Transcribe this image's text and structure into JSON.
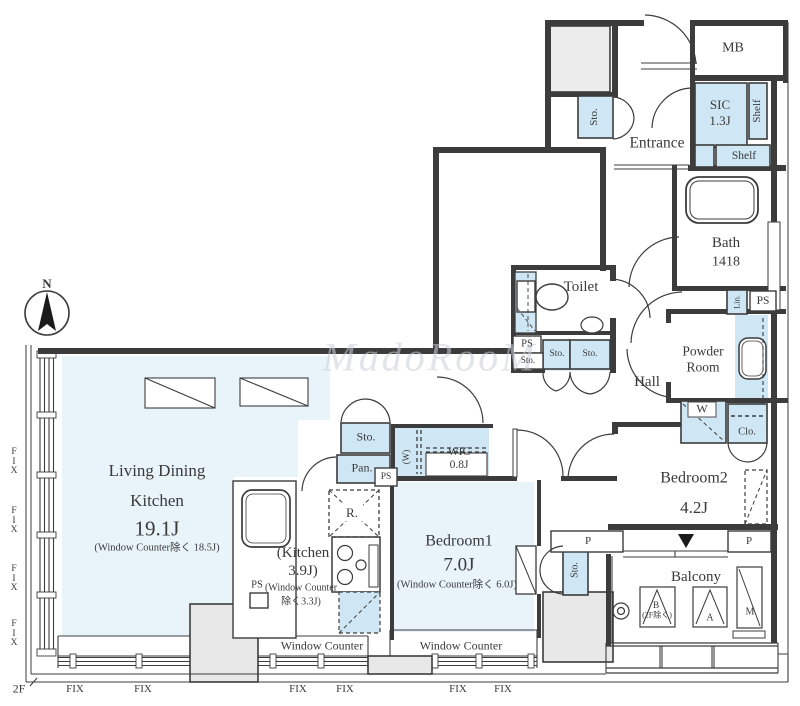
{
  "colors": {
    "wall": "#3c3c3c",
    "storage_fill": "#cfe6f4",
    "room_fill": "#e9f3fa",
    "column_fill": "#e8e8e8",
    "watermark": "#c9cfd6"
  },
  "compass": {
    "label": "N"
  },
  "floor_tag": {
    "label": "2F"
  },
  "watermark": {
    "text": "MadoRooM"
  },
  "labels": {
    "fix": "FIX",
    "fix_v": "F\nI\nX",
    "ps": "PS",
    "sto": "Sto.",
    "pan": "Pan.",
    "shelf": "Shelf",
    "lin": "Lin.",
    "clo": "Clo.",
    "washer": "W",
    "w_rot": "(W)",
    "fridge": "R.",
    "pipe": "P",
    "mb": "MB",
    "window_counter": "Window Counter",
    "ac_b": "B",
    "ac_b_note": "(2F除く)",
    "ac_a": "A",
    "ac_m": "M"
  },
  "rooms": {
    "ldk": {
      "line1": "Living Dining",
      "line2": "Kitchen",
      "size": "19.1J",
      "note": "(Window Counter除く 18.5J)"
    },
    "kitchen": {
      "line1": "(Kitchen",
      "line2": "3.9J)",
      "line3": "(Window Counter",
      "line4": "除く3.3J)"
    },
    "bedroom1": {
      "name": "Bedroom1",
      "size": "7.0J",
      "note": "(Window Counter除く 6.0J)"
    },
    "bedroom2": {
      "name": "Bedroom2",
      "size": "4.2J"
    },
    "wic": {
      "name": "WIC",
      "size": "0.8J"
    },
    "sic": {
      "name": "SIC",
      "size": "1.3J"
    },
    "bath": {
      "name": "Bath",
      "size": "1418"
    },
    "powder": {
      "line1": "Powder",
      "line2": "Room"
    },
    "entrance": "Entrance",
    "hall": "Hall",
    "toilet": "Toilet",
    "balcony": "Balcony"
  }
}
